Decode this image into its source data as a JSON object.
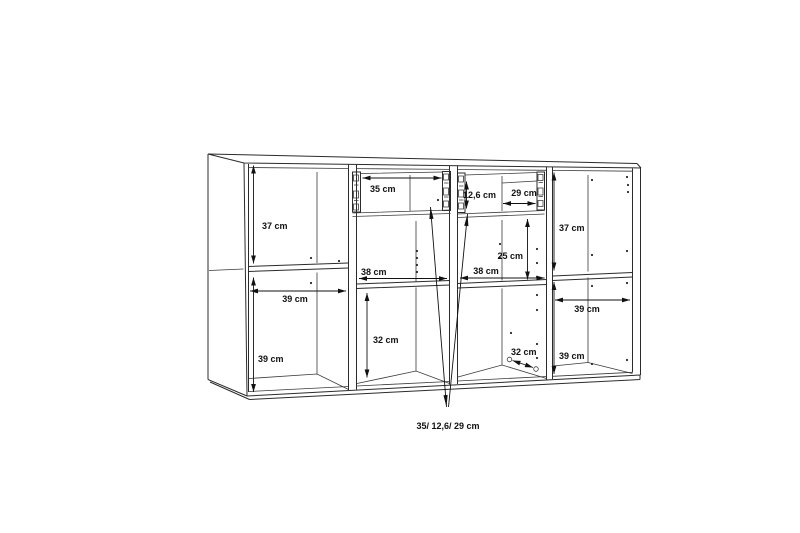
{
  "page": {
    "background": "#ffffff",
    "line_color": "#2b2b2b",
    "text_color": "#111111"
  },
  "drawing": {
    "kind": "sideboard cabinet dimension diagram",
    "unit": "cm"
  },
  "sections": {
    "left": {
      "top_height": "37 cm",
      "width": "39 cm",
      "bottom_height": "39 cm"
    },
    "mid_left": {
      "drawer_width": "35 cm",
      "width": "38 cm",
      "bottom_height": "32 cm"
    },
    "mid_right": {
      "drawer_height": "12,6 cm",
      "drawer_width": "29 cm",
      "middle_height": "25 cm",
      "width": "38 cm",
      "depth": "32 cm"
    },
    "right": {
      "top_height": "37 cm",
      "width": "39 cm",
      "bottom_height": "39 cm"
    }
  },
  "footnote": {
    "drawer_dims": "35/ 12,6/ 29 cm"
  }
}
